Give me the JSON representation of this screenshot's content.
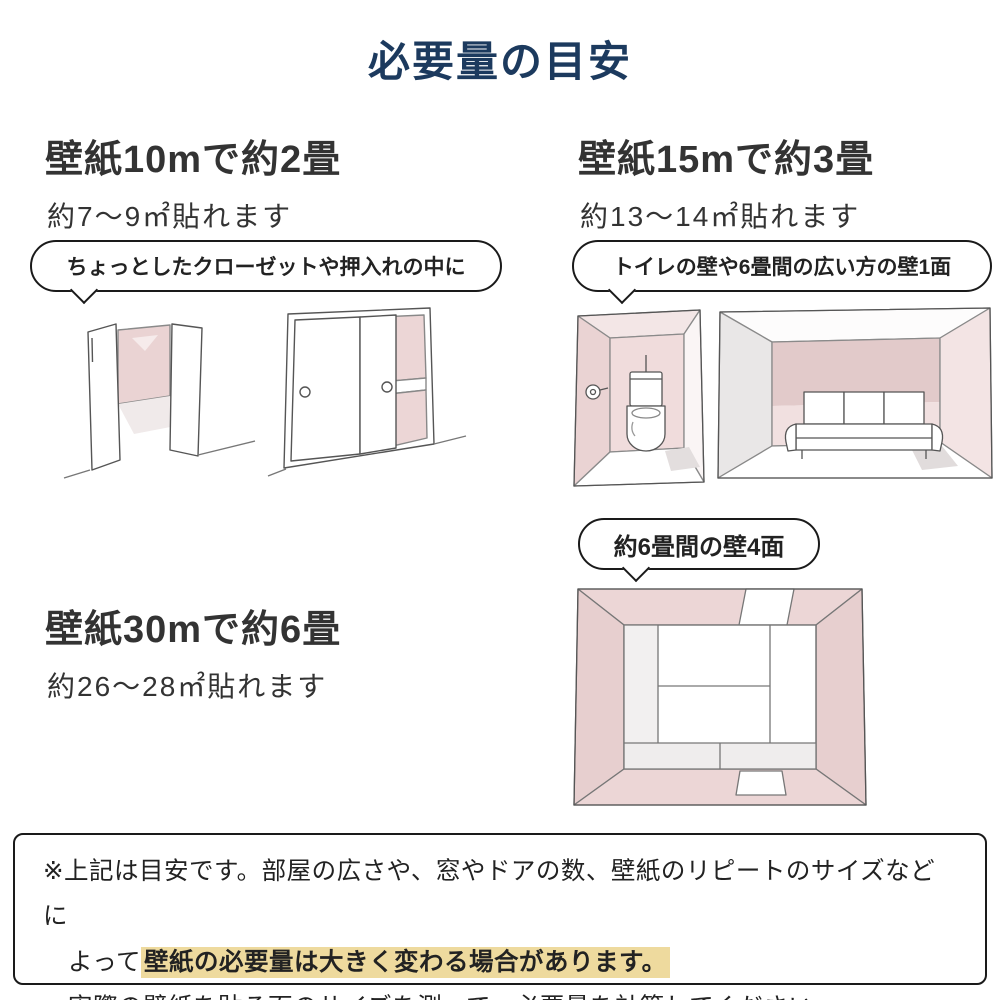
{
  "page": {
    "title": "必要量の目安"
  },
  "colors": {
    "title_navy": "#1c3a5e",
    "text_dark": "#333333",
    "bubble_border": "#1a1a1a",
    "wall_pink": "#ecd6d6",
    "wall_pink_dark": "#e2caca",
    "highlight_yellow": "#eeda9e"
  },
  "sections": [
    {
      "id": "wallpaper-10m",
      "heading": "壁紙10mで約2畳",
      "subheading": "約7〜9㎡貼れます",
      "bubble": "ちょっとしたクローゼットや押入れの中に",
      "illustrations": [
        "open-closet",
        "sliding-door-closet"
      ]
    },
    {
      "id": "wallpaper-15m",
      "heading": "壁紙15mで約3畳",
      "subheading": "約13〜14㎡貼れます",
      "bubble": "トイレの壁や6畳間の広い方の壁1面",
      "illustrations": [
        "toilet-room",
        "sofa-room"
      ]
    },
    {
      "id": "wallpaper-30m",
      "heading": "壁紙30mで約6畳",
      "subheading": "約26〜28㎡貼れます",
      "bubble": "約6畳間の壁4面",
      "illustrations": [
        "tatami-room-top-view"
      ]
    }
  ],
  "note": {
    "line1": "※上記は目安です。部屋の広さや、窓やドアの数、壁紙のリピートのサイズなどに",
    "line2_prefix": "よって",
    "line2_highlight": "壁紙の必要量は大きく変わる場合があります。",
    "line3": "実際の壁紙を貼る面のサイズを測って、必要量を計算してください。"
  }
}
